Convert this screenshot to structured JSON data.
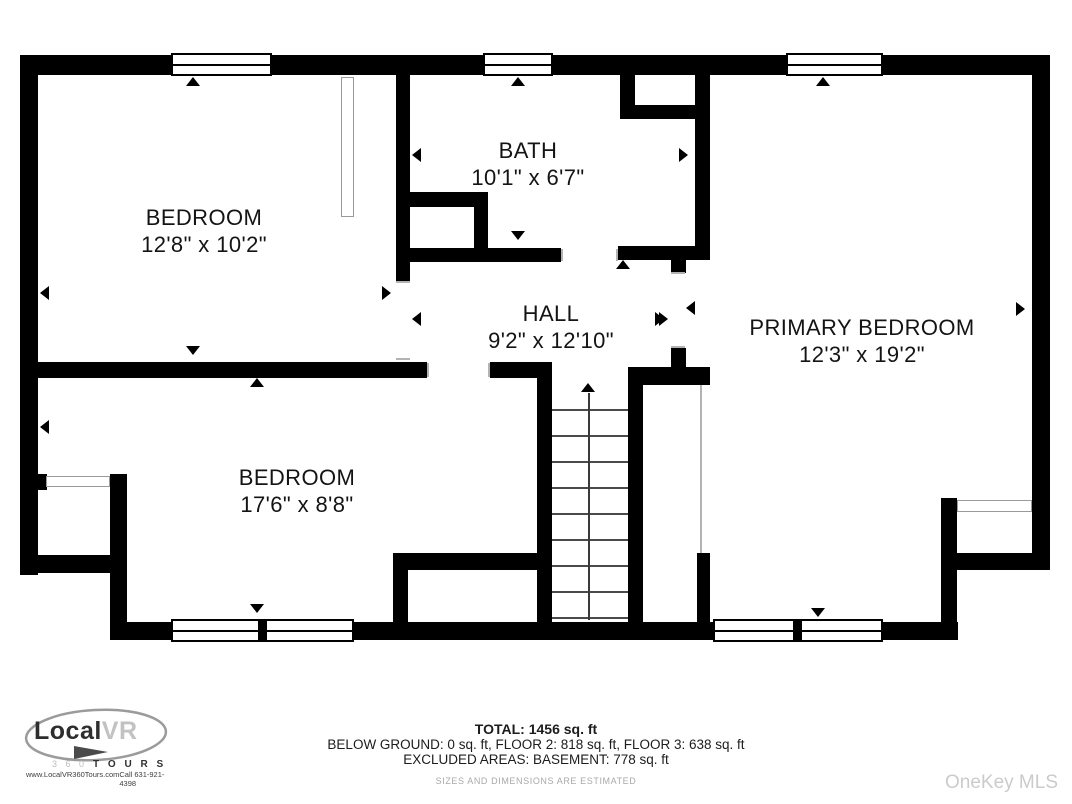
{
  "plan": {
    "rooms": [
      {
        "name": "BEDROOM",
        "dims": "12'8\" x 10'2\""
      },
      {
        "name": "BATH",
        "dims": "10'1\" x 6'7\""
      },
      {
        "name": "HALL",
        "dims": "9'2\" x 12'10\""
      },
      {
        "name": "PRIMARY BEDROOM",
        "dims": "12'3\" x 19'2\""
      },
      {
        "name": "BEDROOM",
        "dims": "17'6\" x 8'8\""
      }
    ]
  },
  "footer": {
    "total_line": "TOTAL: 1456 sq. ft",
    "floors_line": "BELOW GROUND: 0 sq. ft, FLOOR 2: 818 sq. ft, FLOOR 3: 638 sq. ft",
    "excluded_line": "EXCLUDED AREAS: BASEMENT: 778 sq. ft",
    "disclaimer": "SIZES AND DIMENSIONS ARE ESTIMATED",
    "watermark": "OneKey MLS"
  },
  "logo": {
    "brand_dark": "Local",
    "brand_light": "VR",
    "sub_360": "3 6 0",
    "sub_tours": "T O U R S",
    "website": "www.LocalVR360Tours.com",
    "phone": "Call 631-921-4398"
  },
  "colors": {
    "wall": "#000000",
    "tread_line": "#4a4a4a",
    "jamb_line": "#b3b3b3",
    "label_text": "#141414",
    "disclaimer_text": "#a9a9a9",
    "watermark_text": "#cbcbcb"
  }
}
